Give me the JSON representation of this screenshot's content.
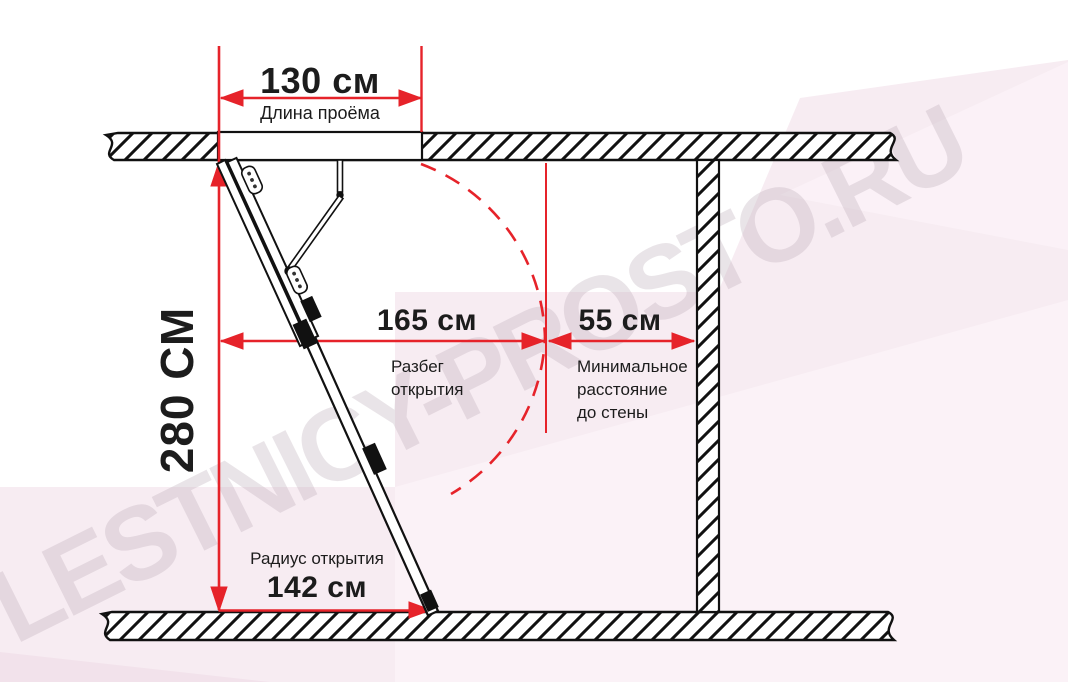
{
  "watermark": {
    "text": "LESTNICY-PROSTO.RU"
  },
  "diagram_type": "attic-ladder-installation-dimensions",
  "dimensions": {
    "opening_length": {
      "value": "130 см",
      "label": "Длина проёма"
    },
    "room_height": {
      "value": "280 СМ"
    },
    "opening_run": {
      "value": "165 см",
      "label": "Разбег\nоткрытия"
    },
    "wall_clearance": {
      "value": "55 см",
      "label": "Минимальное\nрасстояние\nдо стены"
    },
    "opening_radius": {
      "value": "142 см",
      "label": "Радиус открытия"
    }
  },
  "colors": {
    "dimension_red": "#e6232a",
    "line_black": "#111111",
    "text_black": "#1c1c1c",
    "watermark_fill": "#b9a9b4",
    "background_pink_main": "#f7ecf2",
    "background_pink_light": "#fbf2f7",
    "background_pink_dark": "#f2e2eb"
  }
}
